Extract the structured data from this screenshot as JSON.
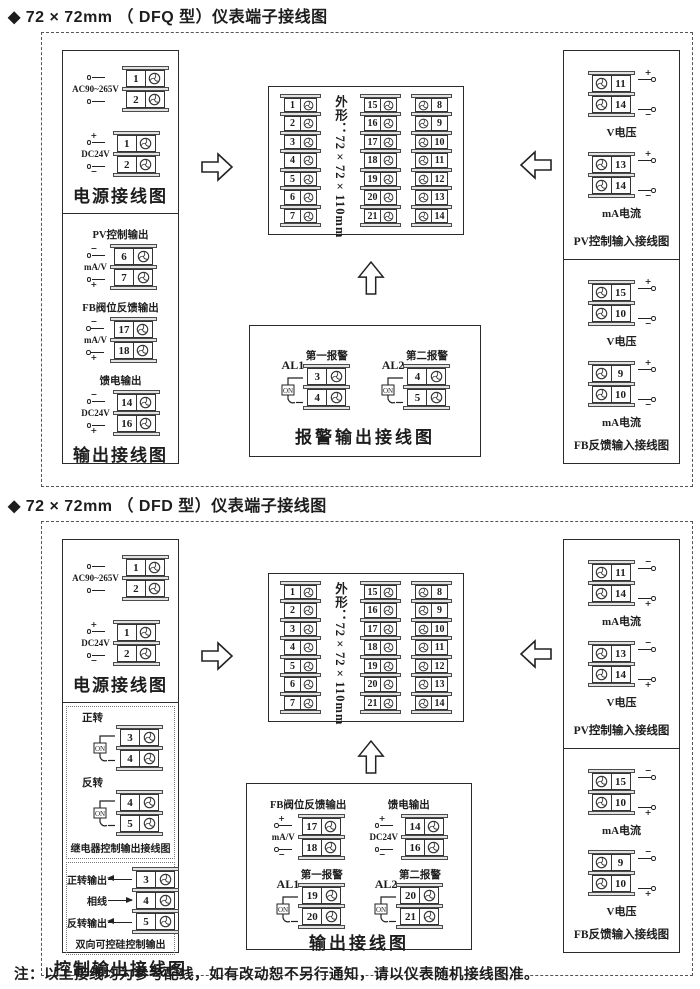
{
  "page": {
    "note": "注：以上接线均为参考配线，如有改动恕不另行通知，请以仪表随机接线图准。"
  },
  "sections": [
    {
      "title": "◆ 72 × 72mm （ DFQ 型）仪表端子接线图",
      "left_top": {
        "caption": "电源接线图",
        "groups": [
          {
            "label": "AC90~265V",
            "top_mark": "",
            "bot_mark": "",
            "nums": [
              "1",
              "2"
            ]
          },
          {
            "label": "DC24V",
            "top_mark": "+",
            "bot_mark": "−",
            "nums": [
              "1",
              "2"
            ]
          }
        ]
      },
      "left_bottom": {
        "caption": "输出接线图",
        "groups": [
          {
            "title": "PV控制输出",
            "label": "mA/V",
            "top_mark": "−",
            "bot_mark": "+",
            "nums": [
              "6",
              "7"
            ]
          },
          {
            "title": "FB阀位反馈输出",
            "label": "mA/V",
            "top_mark": "−",
            "bot_mark": "+",
            "nums": [
              "17",
              "18"
            ]
          },
          {
            "title": "馈电输出",
            "label": "DC24V",
            "top_mark": "−",
            "bot_mark": "+",
            "nums": [
              "14",
              "16"
            ]
          }
        ]
      },
      "center": {
        "shape_label": "外形：72×72×110mm",
        "columns": [
          {
            "nums": [
              "1",
              "2",
              "3",
              "4",
              "5",
              "6",
              "7"
            ],
            "screw": "right"
          },
          {
            "nums": [
              "15",
              "16",
              "17",
              "18",
              "19",
              "20",
              "21"
            ],
            "screw": "right"
          },
          {
            "nums": [
              "8",
              "9",
              "10",
              "11",
              "12",
              "13",
              "14"
            ],
            "screw": "left"
          }
        ]
      },
      "bottom_box": {
        "caption": "报警输出接线图",
        "sig_groups": [],
        "switch_groups": [
          {
            "name": "AL1",
            "title": "第一报警",
            "sw": "ON",
            "nums": [
              "3",
              "4"
            ]
          },
          {
            "name": "AL2",
            "title": "第二报警",
            "sw": "ON",
            "nums": [
              "4",
              "5"
            ]
          }
        ]
      },
      "right_top": {
        "caption": "PV控制输入接线图",
        "groups": [
          {
            "caption": "V电压",
            "top_mark": "+",
            "bot_mark": "−",
            "nums": [
              "11",
              "14"
            ]
          },
          {
            "caption": "mA电流",
            "top_mark": "+",
            "bot_mark": "−",
            "nums": [
              "13",
              "14"
            ]
          }
        ]
      },
      "right_bottom": {
        "caption": "FB反馈输入接线图",
        "groups": [
          {
            "caption": "V电压",
            "top_mark": "+",
            "bot_mark": "−",
            "nums": [
              "15",
              "10"
            ]
          },
          {
            "caption": "mA电流",
            "top_mark": "+",
            "bot_mark": "−",
            "nums": [
              "9",
              "10"
            ]
          }
        ]
      }
    },
    {
      "title": "◆ 72 × 72mm （ DFD 型）仪表端子接线图",
      "left_top": {
        "caption": "电源接线图",
        "groups": [
          {
            "label": "AC90~265V",
            "top_mark": "",
            "bot_mark": "",
            "nums": [
              "1",
              "2"
            ]
          },
          {
            "label": "DC24V",
            "top_mark": "+",
            "bot_mark": "−",
            "nums": [
              "1",
              "2"
            ]
          }
        ]
      },
      "left_bottom": {
        "caption": "控制输出接线图",
        "relay": {
          "caption": "继电器控制输出接线图",
          "groups": [
            {
              "title": "正转",
              "sw": "ON",
              "nums": [
                "3",
                "4"
              ]
            },
            {
              "title": "反转",
              "sw": "ON",
              "nums": [
                "4",
                "5"
              ]
            }
          ]
        },
        "scr": {
          "caption": "双向可控硅控制输出",
          "rows": [
            {
              "label": "正转输出",
              "dir": "out",
              "num": "3"
            },
            {
              "label": "相线",
              "dir": "in",
              "num": "4"
            },
            {
              "label": "反转输出",
              "dir": "out",
              "num": "5"
            }
          ]
        }
      },
      "center": {
        "shape_label": "外形：72×72×110mm",
        "columns": [
          {
            "nums": [
              "1",
              "2",
              "3",
              "4",
              "5",
              "6",
              "7"
            ],
            "screw": "right"
          },
          {
            "nums": [
              "15",
              "16",
              "17",
              "18",
              "19",
              "20",
              "21"
            ],
            "screw": "right"
          },
          {
            "nums": [
              "8",
              "9",
              "10",
              "11",
              "12",
              "13",
              "14"
            ],
            "screw": "left"
          }
        ]
      },
      "bottom_box": {
        "caption": "输出接线图",
        "sig_groups": [
          {
            "title": "FB阀位反馈输出",
            "label": "mA/V",
            "top_mark": "+",
            "bot_mark": "−",
            "nums": [
              "17",
              "18"
            ]
          },
          {
            "title": "馈电输出",
            "label": "DC24V",
            "top_mark": "+",
            "bot_mark": "−",
            "nums": [
              "14",
              "16"
            ]
          }
        ],
        "switch_groups": [
          {
            "name": "AL1",
            "title": "第一报警",
            "sw": "ON",
            "nums": [
              "19",
              "20"
            ]
          },
          {
            "name": "AL2",
            "title": "第二报警",
            "sw": "ON",
            "nums": [
              "20",
              "21"
            ]
          }
        ]
      },
      "right_top": {
        "caption": "PV控制输入接线图",
        "groups": [
          {
            "caption": "mA电流",
            "top_mark": "−",
            "bot_mark": "+",
            "nums": [
              "11",
              "14"
            ]
          },
          {
            "caption": "V电压",
            "top_mark": "−",
            "bot_mark": "+",
            "nums": [
              "13",
              "14"
            ]
          }
        ]
      },
      "right_bottom": {
        "caption": "FB反馈输入接线图",
        "groups": [
          {
            "caption": "mA电流",
            "top_mark": "−",
            "bot_mark": "+",
            "nums": [
              "15",
              "10"
            ]
          },
          {
            "caption": "V电压",
            "top_mark": "−",
            "bot_mark": "+",
            "nums": [
              "9",
              "10"
            ]
          }
        ]
      }
    }
  ]
}
